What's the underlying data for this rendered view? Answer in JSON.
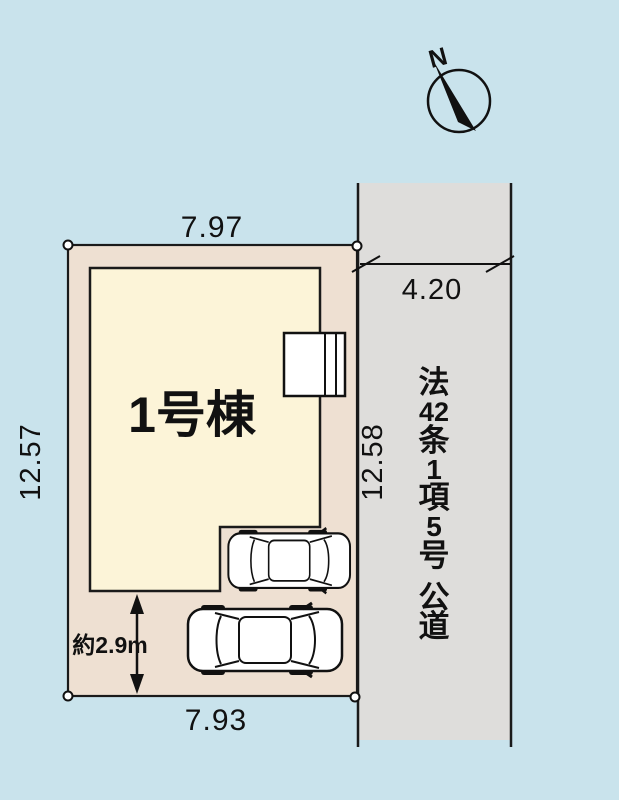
{
  "plan": {
    "building_label": "1号棟",
    "compass_label": "N",
    "road_label": "法42条1項5号 公道",
    "road_label_lines": [
      "法",
      "42",
      "条",
      "1",
      "項",
      "5",
      "号",
      "公",
      "道"
    ],
    "dimensions": {
      "top_width": "7.97",
      "bottom_width": "7.93",
      "left_depth": "12.57",
      "right_depth": "12.58",
      "road_width": "4.20",
      "parking_depth": "約2.9m"
    },
    "colors": {
      "background": "#c9e3ec",
      "lot_fill": "#eee0d2",
      "building_fill": "#fcf4d8",
      "road_fill": "#dedddb",
      "line": "#1a1a1a"
    }
  }
}
